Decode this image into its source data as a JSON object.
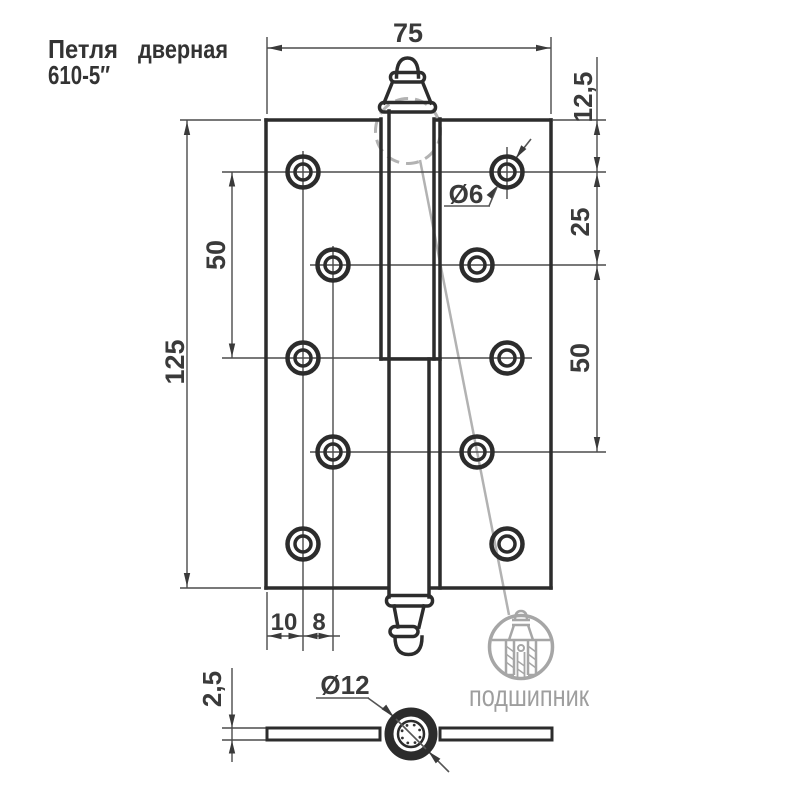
{
  "title": {
    "name_part1": "Петля",
    "name_part2": "дверная",
    "model": "610-5″"
  },
  "dimensions": {
    "plate_width": "75",
    "top_to_row1": "12,5",
    "row1_row2": "25",
    "row2_row4": "50",
    "plate_height": "125",
    "row1_row3": "50",
    "edge_to_col1": "10",
    "col1_col2": "8",
    "hole_dia": "Ø6",
    "knuckle_dia": "Ø12",
    "thickness": "2,5"
  },
  "watermark": {
    "brand": "подшипник"
  },
  "colors": {
    "line_dark": "#2c2c2c",
    "line_thin": "#4b4b4b",
    "watermark_gray": "#a9a9a9"
  }
}
